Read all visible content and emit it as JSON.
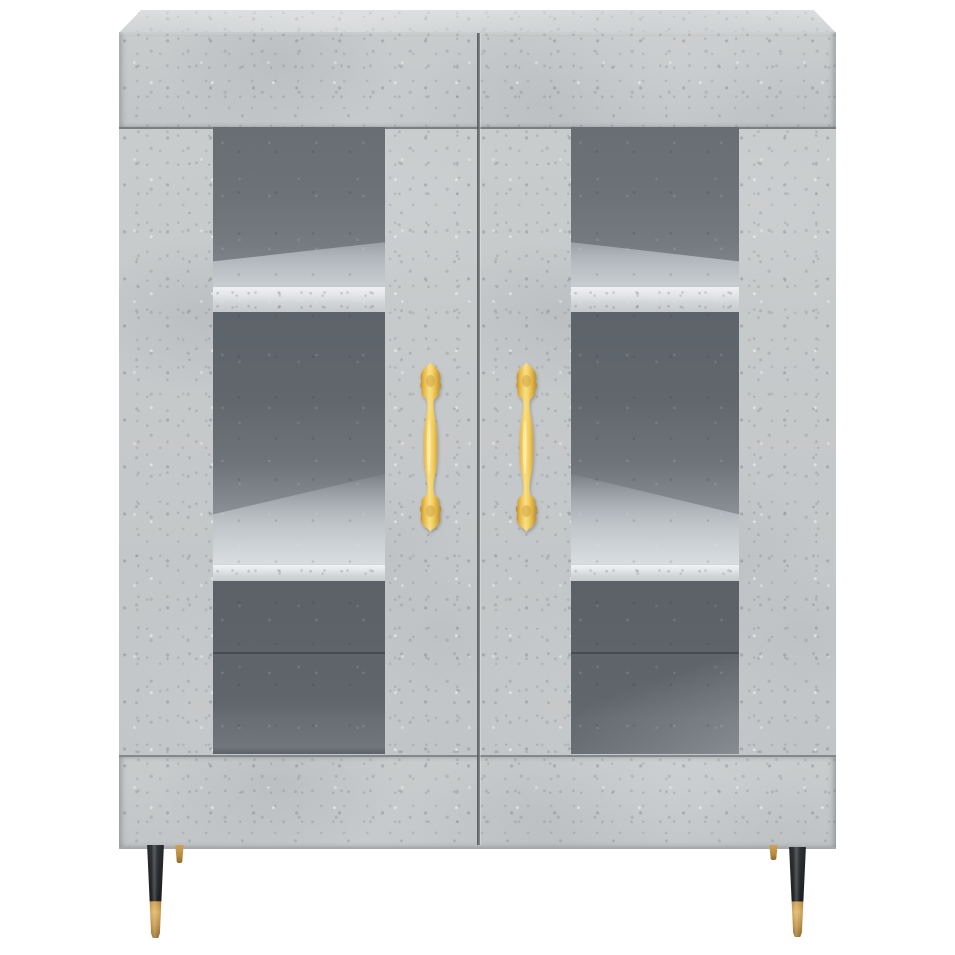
{
  "scene": {
    "description": "Product photograph of a concrete-grey highboard sideboard cabinet with two framed glass-panel doors, ornate gold vertical pull handles, and tapered legs, centered on a plain white background",
    "background_color": "#ffffff"
  },
  "cabinet": {
    "finish": "concrete grey",
    "base_color": "#c5c8ca",
    "top_surface_color": "#d7d9da",
    "seam_color": "#74777a",
    "top_panel": "overhanging top with visible lighter upper surface",
    "door_count": 2,
    "door_style": "concrete-grey frame with tall inset glass panel",
    "glass_color": "#61676d",
    "glass_back_color": "#5b6167",
    "shelf_color": "#d8dbdd",
    "shelves_visible_per_door": 2,
    "compartments_visible_per_door": 3,
    "bottom_rail": "solid concrete-grey plinth band"
  },
  "handles": {
    "count": 2,
    "style": "ornate baroque vertical pull with crest finials and spindle grip",
    "color": "#ecc14f",
    "highlight_color": "#f9e083",
    "shadow_color": "#b9882a"
  },
  "legs": {
    "front": {
      "count": 2,
      "style": "tapered cone",
      "upper_color": "#26292c",
      "tip_color": "#c6984a"
    },
    "rear": {
      "count": 2,
      "style": "short brass stub",
      "color": "#b88c41"
    }
  }
}
